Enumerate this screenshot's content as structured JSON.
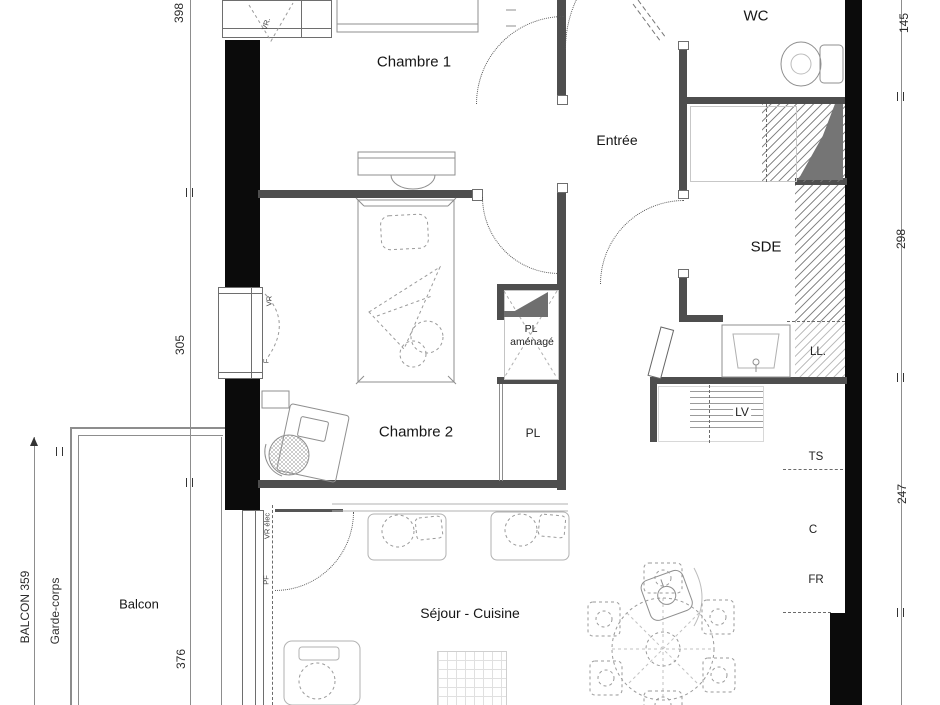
{
  "labels": {
    "chambre1": "Chambre 1",
    "chambre2": "Chambre 2",
    "entree": "Entrée",
    "wc": "WC",
    "sde": "SDE",
    "balcon": "Balcon",
    "sejour_cuisine": "Séjour - Cuisine",
    "pl_amenage_line1": "PL",
    "pl_amenage_line2": "aménagé",
    "pl": "PL",
    "lv": "LV",
    "ll": "LL.",
    "ts": "TS",
    "c": "C",
    "fr": "FR",
    "garde_corps": "Garde-corps"
  },
  "dimensions": {
    "left_top": "398",
    "left_middle": "305",
    "left_bottom": "376",
    "right_top": "145",
    "right_middle": "298",
    "right_bottom": "247",
    "balcon": "BALCON 359"
  },
  "tags": {
    "vr_top": "VR.",
    "vr_left": "VR",
    "f_left": "F",
    "vr_elec": "VR élec",
    "pf": "PF"
  },
  "colors": {
    "exterior_wall": "#0b0b0b",
    "partition_wall": "#4e4e4e",
    "furniture_line": "#9a9a9a",
    "text": "#161616"
  }
}
